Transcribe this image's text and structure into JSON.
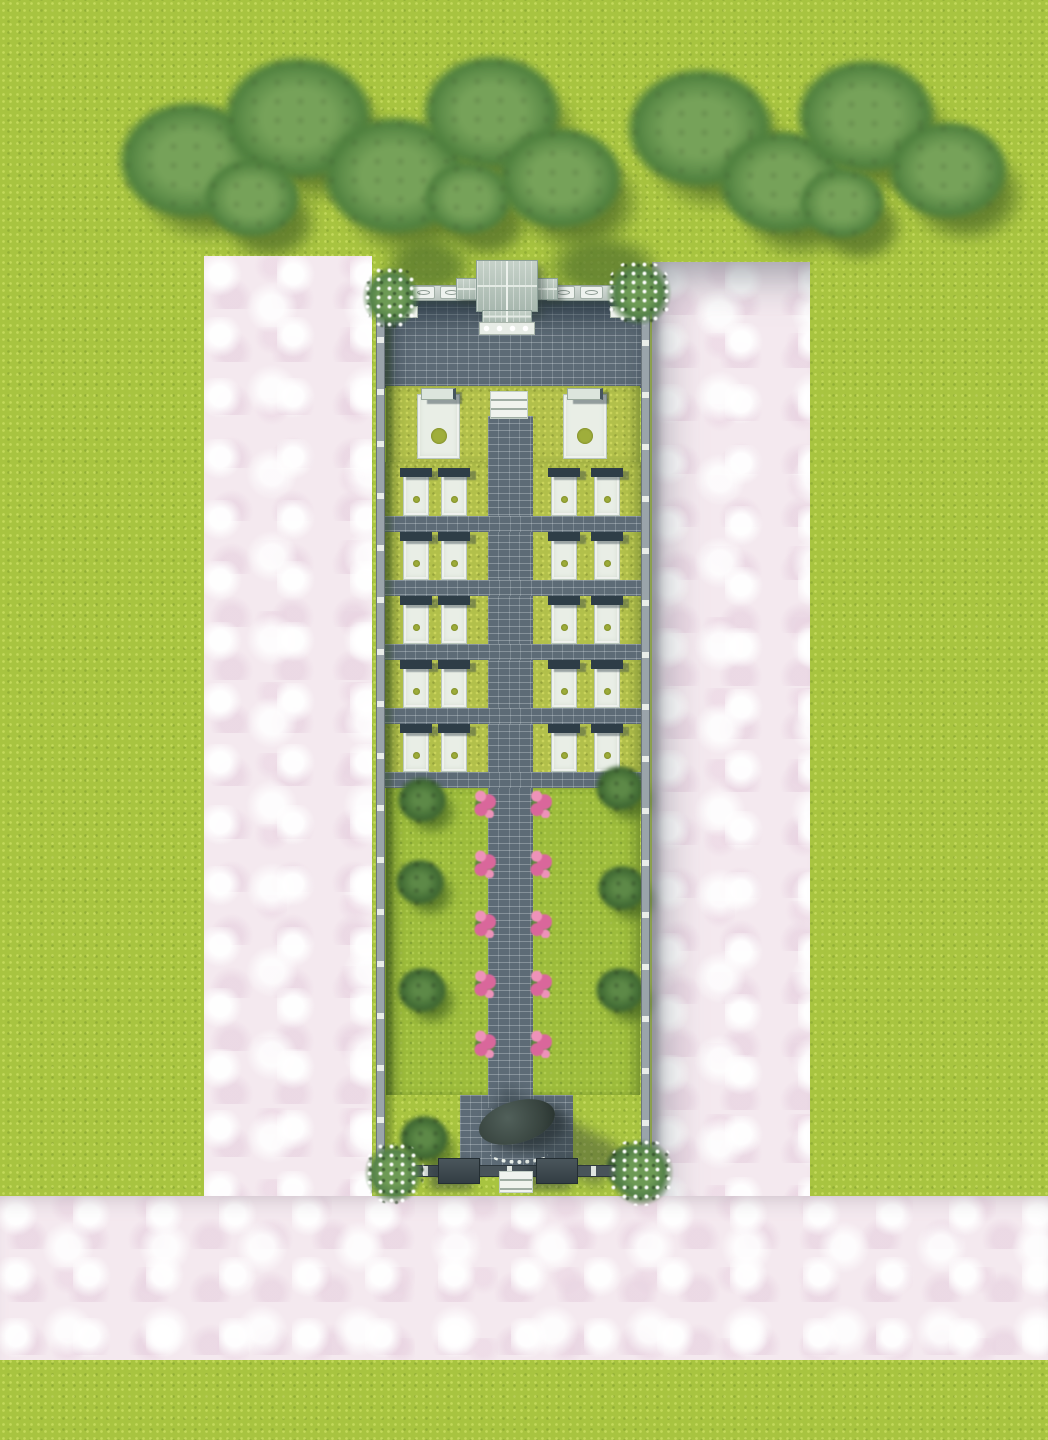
{
  "scene": {
    "description": "Aerial 3D rendering of a long walled cemetery garden: tree belt at top, pink stone walkways around the enclosure, entrance gate pavilion, paved courtyard, two large monument plots, five rows of four grave plots, a flower-lined central path through a lawn with trees, and a rear altar platform with exit gate.",
    "no_visible_text": true
  },
  "colors": {
    "grass": "#a8c440",
    "pink": "#f4e9ef",
    "brick": "#5d6b76",
    "wall": "#9aa4aa",
    "wallpost": "#e9ede9",
    "slab": "#e9eee6",
    "slabedge": "#b9c6bc",
    "headstone": "#2e3d47",
    "dot": "#9fae3b",
    "plotgrass": "#b2c04b",
    "lawn": "#9dbc3c",
    "flower": "#d9679b",
    "flowerlight": "#ee92b9",
    "stepwhite": "#f0f3ee",
    "gateroof": "#b6c3bb",
    "darkwall": "#3c484e",
    "altarroof": "#37433e"
  },
  "tree_band": {
    "canopies": [
      {
        "cx": 190,
        "cy": 160,
        "r": 74
      },
      {
        "cx": 298,
        "cy": 118,
        "r": 78
      },
      {
        "cx": 395,
        "cy": 175,
        "r": 75
      },
      {
        "cx": 492,
        "cy": 112,
        "r": 72
      },
      {
        "cx": 560,
        "cy": 178,
        "r": 65
      },
      {
        "cx": 468,
        "cy": 198,
        "r": 46
      },
      {
        "cx": 252,
        "cy": 198,
        "r": 50
      },
      {
        "cx": 700,
        "cy": 128,
        "r": 76
      },
      {
        "cx": 782,
        "cy": 182,
        "r": 66
      },
      {
        "cx": 866,
        "cy": 116,
        "r": 72
      },
      {
        "cx": 948,
        "cy": 170,
        "r": 62
      },
      {
        "cx": 842,
        "cy": 203,
        "r": 45
      }
    ],
    "shadow_offset": {
      "dx": 18,
      "dy": 24
    }
  },
  "pavement": {
    "left": {
      "x": 204,
      "y": 256,
      "w": 168,
      "h": 1104
    },
    "right": {
      "x": 652,
      "y": 262,
      "w": 158,
      "h": 1098
    },
    "bottom": {
      "x": 0,
      "y": 1196,
      "w": 1048,
      "h": 164
    }
  },
  "compound": {
    "x": 372,
    "y": 260,
    "w": 282,
    "h": 935,
    "gate_shadows": [
      {
        "x": 8,
        "y": -24,
        "w": 96,
        "h": 62
      },
      {
        "x": 170,
        "y": -28,
        "w": 122,
        "h": 70
      },
      {
        "x": 198,
        "y": 38,
        "w": 84,
        "h": 46
      }
    ],
    "walls": {
      "left": {
        "x": 4,
        "y": 25,
        "w": 9,
        "h": 902
      },
      "right": {
        "x": 269,
        "y": 28,
        "w": 9,
        "h": 899
      },
      "top_left": {
        "x": 4,
        "y": 25,
        "w": 101,
        "h": 16
      },
      "top_right": {
        "x": 175,
        "y": 25,
        "w": 103,
        "h": 16
      },
      "bottom": {
        "x": 8,
        "y": 905,
        "w": 266,
        "h": 12
      },
      "panel_xs": [
        40,
        68,
        180,
        208
      ],
      "panel_y": 26
    },
    "gate": {
      "wing": {
        "x": 84,
        "y": 18,
        "w": 102,
        "h": 22
      },
      "roof": {
        "x": 104,
        "y": 0,
        "w": 62,
        "h": 52
      },
      "porch": {
        "x": 110,
        "y": 50,
        "w": 50,
        "h": 13
      },
      "base": {
        "x": 107,
        "y": 62,
        "w": 56,
        "h": 13
      }
    },
    "courtyard": {
      "x": 12,
      "y": 40,
      "w": 258,
      "h": 88
    },
    "monument_row": {
      "x": 14,
      "y": 126,
      "w": 254,
      "h": 76,
      "slab_y": 128,
      "slab_h": 71,
      "slabs": [
        {
          "x": 45,
          "w": 43
        },
        {
          "x": 191,
          "w": 44
        }
      ],
      "steps": {
        "x": 118,
        "y": 131,
        "w": 38,
        "h": 28
      }
    },
    "grave_rows": {
      "x": 12,
      "y": 202,
      "w": 258,
      "h": 326,
      "grass_left": {
        "x": 18,
        "w": 95
      },
      "grass_right": {
        "x": 170,
        "w": 96
      },
      "rows": 5,
      "first_plot_y": 208,
      "plot_h": 48,
      "strip_h": 16,
      "row_step": 64,
      "slab_xs": [
        31,
        69,
        179,
        222
      ],
      "slab_w": 26,
      "slab_h": 44
    },
    "path": {
      "x": 116,
      "y": 156,
      "w": 45,
      "h": 692
    },
    "garden": {
      "x": 14,
      "y": 528,
      "w": 254,
      "h": 307,
      "flowers_y": [
        530,
        590,
        650,
        710,
        770
      ],
      "flower_xs": [
        102,
        158
      ],
      "trees_left": [
        {
          "cx": 50,
          "cy": 540
        },
        {
          "cx": 48,
          "cy": 622
        },
        {
          "cx": 50,
          "cy": 730
        },
        {
          "cx": 52,
          "cy": 878
        }
      ],
      "trees_right": [
        {
          "cx": 248,
          "cy": 528
        },
        {
          "cx": 250,
          "cy": 628
        },
        {
          "cx": 248,
          "cy": 730
        },
        {
          "cx": 258,
          "cy": 908
        }
      ]
    },
    "platform": {
      "x": 88,
      "y": 835,
      "w": 113,
      "h": 77
    },
    "altar": {
      "cx": 145,
      "cy": 862,
      "w": 78,
      "h": 42,
      "arc": {
        "x": 118,
        "y": 884,
        "w": 58,
        "h": 20
      }
    },
    "bottom_gate": {
      "blocks": [
        {
          "x": 66,
          "w": 42
        },
        {
          "x": 164,
          "w": 42
        }
      ],
      "block_y": 898,
      "block_h": 26,
      "steps": {
        "x": 127,
        "y": 911,
        "w": 34,
        "h": 22
      }
    },
    "corner_bushes": [
      {
        "x": -10,
        "y": 6,
        "w": 58,
        "h": 62
      },
      {
        "x": 234,
        "y": 0,
        "w": 66,
        "h": 66
      },
      {
        "x": -8,
        "y": 882,
        "w": 60,
        "h": 62
      },
      {
        "x": 236,
        "y": 878,
        "w": 66,
        "h": 68
      }
    ],
    "planters": [
      {
        "x": 22,
        "y": 46,
        "w": 24,
        "h": 12
      },
      {
        "x": 238,
        "y": 46,
        "w": 24,
        "h": 12
      }
    ]
  }
}
